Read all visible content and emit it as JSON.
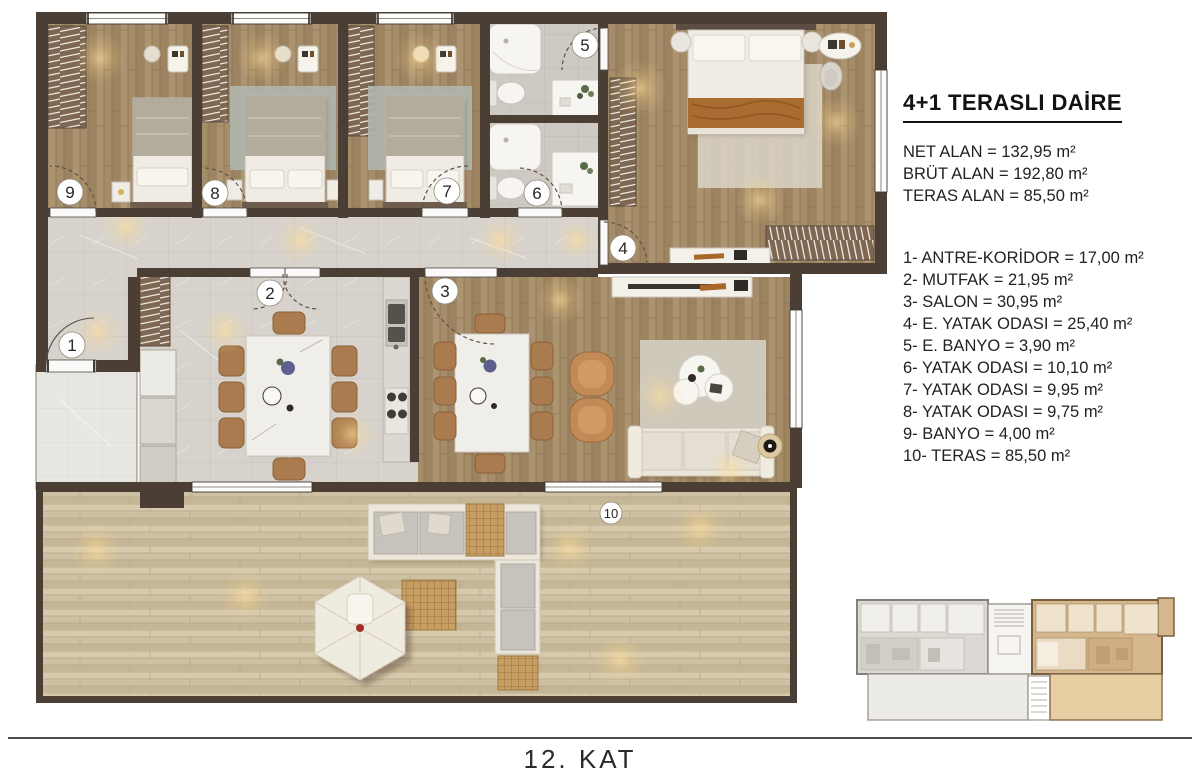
{
  "info_panel": {
    "title": "4+1 TERASLI DAİRE",
    "stats": [
      "NET ALAN = 132,95 m²",
      "BRÜT ALAN = 192,80 m²",
      "TERAS ALAN = 85,50 m²"
    ],
    "rooms": [
      "1- ANTRE-KORİDOR = 17,00 m²",
      "2- MUTFAK = 21,95 m²",
      "3- SALON = 30,95 m²",
      "4- E. YATAK ODASI = 25,40 m²",
      "5- E. BANYO = 3,90 m²",
      "6- YATAK ODASI = 10,10 m²",
      "7- YATAK ODASI = 9,95 m²",
      "8- YATAK ODASI = 9,75 m²",
      "9- BANYO = 4,00 m²",
      "10- TERAS = 85,50 m²"
    ]
  },
  "floor_label": "12. KAT",
  "plan": {
    "labels": [
      "1",
      "2",
      "3",
      "4",
      "5",
      "6",
      "7",
      "8",
      "9",
      "10"
    ],
    "colors": {
      "wall": "#4b3f35",
      "bedroom_wood": "#a68d69",
      "tile": "#d7d3cc",
      "bath_tile": "#cecac3",
      "terrace_wood": "#cec0a2",
      "highlight_unit": "#d6b68c"
    }
  }
}
